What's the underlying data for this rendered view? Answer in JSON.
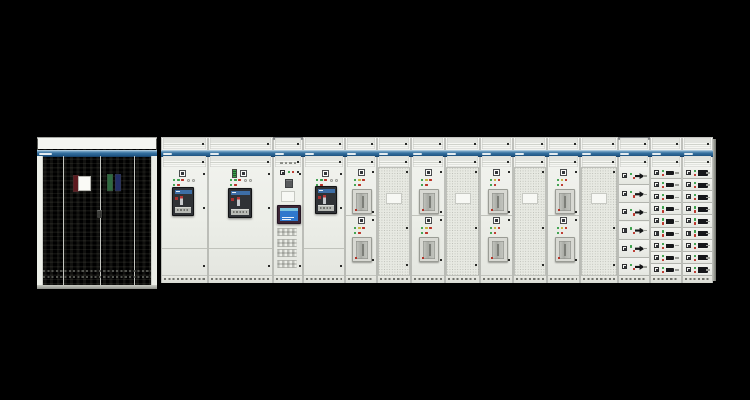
{
  "scene": {
    "title": "Low-voltage switchgear and motor control center lineup on black background",
    "background": "#000000"
  },
  "palette": {
    "body": "#eef0ea",
    "band_blue": "#2b6394",
    "led_green": "#3aa04a",
    "led_yellow": "#c8b23a",
    "led_red": "#bb3328",
    "breaker_black": "#1b1d20",
    "breaker_blue": "#3d6ea6",
    "breaker_red": "#a83030",
    "breaker_gray": "#c3c5c0",
    "screen_blue": "#2f78cc",
    "clip_red": "#5e1a1f",
    "clip_green": "#2f6b40",
    "clip_navy": "#232e66"
  },
  "geometry": {
    "stage_w": 750,
    "stage_h": 400,
    "lineup_top": 137,
    "section_h": 146,
    "vent1_top": 1,
    "vent_h": 11,
    "band_top": 13,
    "band_h": 6,
    "vent2_top": 19,
    "door_top": 30,
    "door_bottom": 7,
    "kick_h": 7
  },
  "left_cabinet": {
    "x": 37,
    "y": 137,
    "w": 120,
    "h": 152,
    "band_top": 13,
    "band_h": 6,
    "seams": [
      26,
      63,
      97
    ],
    "stile_w": 6,
    "clips": [
      {
        "name": "red-document-clip",
        "color": "#5e1a1f",
        "x": 36,
        "y": 38,
        "w": 4,
        "h": 15
      },
      {
        "name": "white-label-card",
        "color": "#fafaf6",
        "x": 41,
        "y": 39,
        "w": 11,
        "h": 13
      },
      {
        "name": "green-document-clip",
        "color": "#2f6b40",
        "x": 70,
        "y": 37,
        "w": 4,
        "h": 15
      },
      {
        "name": "navy-document-clip",
        "color": "#232e66",
        "x": 78,
        "y": 37,
        "w": 4,
        "h": 15
      }
    ],
    "handle": {
      "x": 60,
      "y": 73,
      "w": 5,
      "h": 8
    },
    "kick_rows": [
      133,
      139
    ]
  },
  "right_end_panel": {
    "x": 713,
    "y": 139,
    "w": 3,
    "h": 142
  },
  "acb_leds": {
    "row1": [
      "green",
      "green",
      "red"
    ],
    "row2": [
      "green",
      "red"
    ],
    "round_buttons": 2
  },
  "mccb_leds": {
    "row1": [
      "green",
      "yellow",
      "red"
    ],
    "row2": [
      "green",
      "red"
    ]
  },
  "drawer_leds": [
    "green",
    "red"
  ],
  "sections": [
    {
      "id": "incomer-acb-1",
      "type": "acb",
      "x": 161,
      "w": 47,
      "meter": false,
      "breaker": {
        "x": 10,
        "y": 20,
        "w": 20,
        "h": 27
      }
    },
    {
      "id": "incomer-acb-2",
      "type": "acb",
      "x": 208,
      "w": 65,
      "meter": true,
      "breaker": {
        "x": 19,
        "y": 21,
        "w": 22,
        "h": 28
      }
    },
    {
      "id": "control-hmi",
      "type": "control",
      "x": 273,
      "w": 30,
      "cap": true
    },
    {
      "id": "incomer-acb-3",
      "type": "acb",
      "x": 303,
      "w": 42,
      "meter": false,
      "breaker": {
        "x": 11,
        "y": 19,
        "w": 20,
        "h": 26
      }
    },
    {
      "id": "feeder-mccb-1",
      "type": "mccb2",
      "x": 345,
      "w": 32
    },
    {
      "id": "vented-panel-1",
      "type": "mesh",
      "x": 377,
      "w": 34
    },
    {
      "id": "feeder-mccb-2",
      "type": "mccb2",
      "x": 411,
      "w": 34
    },
    {
      "id": "vented-panel-2",
      "type": "mesh",
      "x": 445,
      "w": 35
    },
    {
      "id": "feeder-mccb-3",
      "type": "mccb2",
      "x": 480,
      "w": 33
    },
    {
      "id": "vented-panel-3",
      "type": "mesh",
      "x": 513,
      "w": 34
    },
    {
      "id": "feeder-mccb-4",
      "type": "mccb2",
      "x": 547,
      "w": 33
    },
    {
      "id": "vented-panel-4",
      "type": "mesh",
      "x": 580,
      "w": 38
    },
    {
      "id": "mcc-drawers-a",
      "type": "drawer",
      "x": 618,
      "w": 32,
      "rows": 6,
      "handle": "wedge",
      "cap": true
    },
    {
      "id": "mcc-drawers-b",
      "type": "drawer",
      "x": 650,
      "w": 32,
      "rows": 9,
      "handle": "bar"
    },
    {
      "id": "mcc-drawers-c",
      "type": "drawer",
      "x": 682,
      "w": 31,
      "rows": 9,
      "handle": "bar-wide"
    }
  ]
}
